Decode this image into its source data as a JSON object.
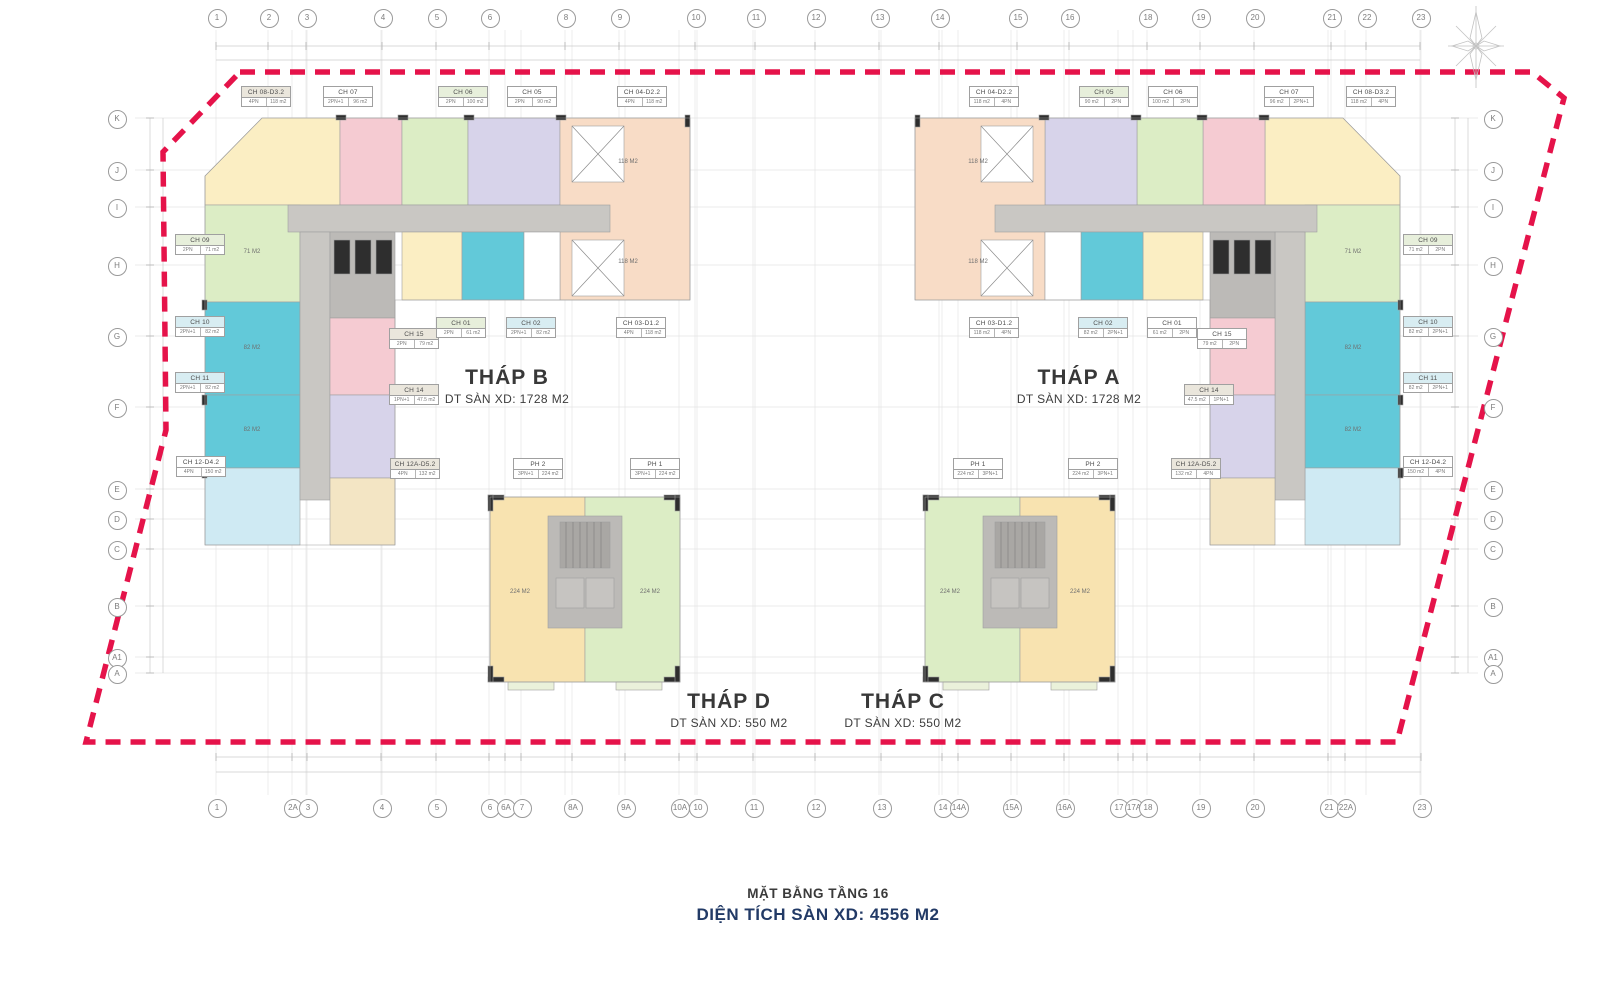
{
  "title": {
    "line1": "MẶT BẰNG TẦNG 16",
    "line2": "DIỆN TÍCH SÀN XD: 4556 M2"
  },
  "towers": [
    {
      "id": "B",
      "name": "THÁP B",
      "area": "DT SÀN XD: 1728 M2"
    },
    {
      "id": "A",
      "name": "THÁP A",
      "area": "DT SÀN XD: 1728 M2"
    },
    {
      "id": "D",
      "name": "THÁP D",
      "area": "DT SÀN XD: 550 M2"
    },
    {
      "id": "C",
      "name": "THÁP C",
      "area": "DT SÀN XD: 550 M2"
    }
  ],
  "grid": {
    "top_columns": [
      {
        "label": "1",
        "x": 216
      },
      {
        "label": "2",
        "x": 268
      },
      {
        "label": "3",
        "x": 306
      },
      {
        "label": "4",
        "x": 382
      },
      {
        "label": "5",
        "x": 436
      },
      {
        "label": "6",
        "x": 489
      },
      {
        "label": "8",
        "x": 565
      },
      {
        "label": "9",
        "x": 619
      },
      {
        "label": "10",
        "x": 695
      },
      {
        "label": "11",
        "x": 755
      },
      {
        "label": "12",
        "x": 815
      },
      {
        "label": "13",
        "x": 879
      },
      {
        "label": "14",
        "x": 939
      },
      {
        "label": "15",
        "x": 1017
      },
      {
        "label": "16",
        "x": 1069
      },
      {
        "label": "18",
        "x": 1147
      },
      {
        "label": "19",
        "x": 1200
      },
      {
        "label": "20",
        "x": 1254
      },
      {
        "label": "21",
        "x": 1331
      },
      {
        "label": "22",
        "x": 1366
      },
      {
        "label": "23",
        "x": 1420
      }
    ],
    "bottom_columns": [
      {
        "label": "1",
        "x": 216
      },
      {
        "label": "2A",
        "x": 292
      },
      {
        "label": "3",
        "x": 307
      },
      {
        "label": "4",
        "x": 381
      },
      {
        "label": "5",
        "x": 436
      },
      {
        "label": "6",
        "x": 489
      },
      {
        "label": "6A",
        "x": 505
      },
      {
        "label": "7",
        "x": 521
      },
      {
        "label": "8A",
        "x": 572
      },
      {
        "label": "9A",
        "x": 625
      },
      {
        "label": "10A",
        "x": 679
      },
      {
        "label": "10",
        "x": 697
      },
      {
        "label": "11",
        "x": 753
      },
      {
        "label": "12",
        "x": 815
      },
      {
        "label": "13",
        "x": 881
      },
      {
        "label": "14",
        "x": 942
      },
      {
        "label": "14A",
        "x": 958
      },
      {
        "label": "15A",
        "x": 1011
      },
      {
        "label": "16A",
        "x": 1064
      },
      {
        "label": "17",
        "x": 1118
      },
      {
        "label": "17A",
        "x": 1133
      },
      {
        "label": "18",
        "x": 1147
      },
      {
        "label": "19",
        "x": 1200
      },
      {
        "label": "20",
        "x": 1254
      },
      {
        "label": "21",
        "x": 1328
      },
      {
        "label": "22A",
        "x": 1345
      },
      {
        "label": "23",
        "x": 1421
      }
    ],
    "left_rows": [
      {
        "label": "K",
        "y": 118
      },
      {
        "label": "J",
        "y": 170
      },
      {
        "label": "I",
        "y": 207
      },
      {
        "label": "H",
        "y": 265
      },
      {
        "label": "G",
        "y": 336
      },
      {
        "label": "F",
        "y": 407
      },
      {
        "label": "E",
        "y": 489
      },
      {
        "label": "D",
        "y": 519
      },
      {
        "label": "C",
        "y": 549
      },
      {
        "label": "B",
        "y": 606
      },
      {
        "label": "A1",
        "y": 657
      },
      {
        "label": "A",
        "y": 673
      }
    ],
    "right_rows": [
      {
        "label": "K",
        "y": 118
      },
      {
        "label": "J",
        "y": 170
      },
      {
        "label": "I",
        "y": 207
      },
      {
        "label": "H",
        "y": 265
      },
      {
        "label": "G",
        "y": 336
      },
      {
        "label": "F",
        "y": 407
      },
      {
        "label": "E",
        "y": 489
      },
      {
        "label": "D",
        "y": 519
      },
      {
        "label": "C",
        "y": 549
      },
      {
        "label": "B",
        "y": 606
      },
      {
        "label": "A1",
        "y": 657
      },
      {
        "label": "A",
        "y": 673
      }
    ]
  },
  "unit_labels": [
    {
      "id": "CH 08-D3.2",
      "bed": "4PN",
      "area": "118 m2",
      "tint": "gray",
      "x": 266,
      "y": 95,
      "flip": false
    },
    {
      "id": "CH 07",
      "bed": "2PN+1",
      "area": "96 m2",
      "tint": "white",
      "x": 348,
      "y": 95,
      "flip": false
    },
    {
      "id": "CH 06",
      "bed": "2PN",
      "area": "100 m2",
      "tint": "green",
      "x": 463,
      "y": 95,
      "flip": false
    },
    {
      "id": "CH 05",
      "bed": "2PN",
      "area": "90 m2",
      "tint": "white",
      "x": 532,
      "y": 95,
      "flip": false
    },
    {
      "id": "CH 04-D2.2",
      "bed": "4PN",
      "area": "118 m2",
      "tint": "white",
      "x": 642,
      "y": 95,
      "flip": false
    },
    {
      "id": "CH 09",
      "bed": "2PN",
      "area": "71 m2",
      "tint": "green",
      "x": 200,
      "y": 243,
      "flip": false
    },
    {
      "id": "CH 10",
      "bed": "2PN+1",
      "area": "82 m2",
      "tint": "cyan",
      "x": 200,
      "y": 325,
      "flip": false
    },
    {
      "id": "CH 11",
      "bed": "2PN+1",
      "area": "82 m2",
      "tint": "cyan",
      "x": 200,
      "y": 381,
      "flip": false
    },
    {
      "id": "CH 12-D4.2",
      "bed": "4PN",
      "area": "150 m2",
      "tint": "white",
      "x": 201,
      "y": 465,
      "flip": false
    },
    {
      "id": "CH 15",
      "bed": "2PN",
      "area": "79 m2",
      "tint": "gray",
      "x": 414,
      "y": 337,
      "flip": false
    },
    {
      "id": "CH 01",
      "bed": "2PN",
      "area": "61 m2",
      "tint": "green",
      "x": 461,
      "y": 326,
      "flip": false
    },
    {
      "id": "CH 02",
      "bed": "2PN+1",
      "area": "82 m2",
      "tint": "cyan",
      "x": 531,
      "y": 326,
      "flip": false
    },
    {
      "id": "CH 03-D1.2",
      "bed": "4PN",
      "area": "118 m2",
      "tint": "white",
      "x": 641,
      "y": 326,
      "flip": false
    },
    {
      "id": "CH 14",
      "bed": "1PN+1",
      "area": "47.5 m2",
      "tint": "gray",
      "x": 414,
      "y": 393,
      "flip": false
    },
    {
      "id": "CH 12A-D5.2",
      "bed": "4PN",
      "area": "132 m2",
      "tint": "gray",
      "x": 415,
      "y": 467,
      "flip": false
    },
    {
      "id": "PH 2",
      "bed": "3PN+1",
      "area": "224 m2",
      "tint": "white",
      "x": 538,
      "y": 467,
      "flip": false
    },
    {
      "id": "PH 1",
      "bed": "3PN+1",
      "area": "224 m2",
      "tint": "white",
      "x": 655,
      "y": 467,
      "flip": false
    },
    {
      "id": "PH 1",
      "bed": "3PN+1",
      "area": "224 m2",
      "tint": "white",
      "x": 978,
      "y": 467,
      "flip": true
    },
    {
      "id": "PH 2",
      "bed": "3PN+1",
      "area": "224 m2",
      "tint": "white",
      "x": 1093,
      "y": 467,
      "flip": true
    },
    {
      "id": "CH 04-D2.2",
      "bed": "4PN",
      "area": "118 m2",
      "tint": "white",
      "x": 994,
      "y": 95,
      "flip": true
    },
    {
      "id": "CH 05",
      "bed": "2PN",
      "area": "90 m2",
      "tint": "green",
      "x": 1104,
      "y": 95,
      "flip": true
    },
    {
      "id": "CH 06",
      "bed": "2PN",
      "area": "100 m2",
      "tint": "white",
      "x": 1173,
      "y": 95,
      "flip": true
    },
    {
      "id": "CH 07",
      "bed": "2PN+1",
      "area": "96 m2",
      "tint": "white",
      "x": 1289,
      "y": 95,
      "flip": true
    },
    {
      "id": "CH 08-D3.2",
      "bed": "4PN",
      "area": "118 m2",
      "tint": "white",
      "x": 1371,
      "y": 95,
      "flip": true
    },
    {
      "id": "CH 03-D1.2",
      "bed": "4PN",
      "area": "118 m2",
      "tint": "white",
      "x": 994,
      "y": 326,
      "flip": true
    },
    {
      "id": "CH 02",
      "bed": "2PN+1",
      "area": "82 m2",
      "tint": "cyan",
      "x": 1103,
      "y": 326,
      "flip": true
    },
    {
      "id": "CH 01",
      "bed": "2PN",
      "area": "61 m2",
      "tint": "white",
      "x": 1172,
      "y": 326,
      "flip": true
    },
    {
      "id": "CH 15",
      "bed": "2PN",
      "area": "79 m2",
      "tint": "white",
      "x": 1222,
      "y": 337,
      "flip": true
    },
    {
      "id": "CH 14",
      "bed": "1PN+1",
      "area": "47.5 m2",
      "tint": "gray",
      "x": 1209,
      "y": 393,
      "flip": true
    },
    {
      "id": "CH 12A-D5.2",
      "bed": "4PN",
      "area": "132 m2",
      "tint": "gray",
      "x": 1196,
      "y": 467,
      "flip": true
    },
    {
      "id": "CH 09",
      "bed": "2PN",
      "area": "71 m2",
      "tint": "green",
      "x": 1428,
      "y": 243,
      "flip": true
    },
    {
      "id": "CH 10",
      "bed": "2PN+1",
      "area": "82 m2",
      "tint": "cyan",
      "x": 1428,
      "y": 325,
      "flip": true
    },
    {
      "id": "CH 11",
      "bed": "2PN+1",
      "area": "82 m2",
      "tint": "cyan",
      "x": 1428,
      "y": 381,
      "flip": true
    },
    {
      "id": "CH 12-D4.2",
      "bed": "4PN",
      "area": "150 m2",
      "tint": "white",
      "x": 1428,
      "y": 465,
      "flip": true
    }
  ],
  "in_plan_texts": [
    {
      "t": "71 M2",
      "x": 252,
      "y": 252
    },
    {
      "t": "82 M2",
      "x": 252,
      "y": 348
    },
    {
      "t": "82 M2",
      "x": 252,
      "y": 430
    },
    {
      "t": "118 M2",
      "x": 628,
      "y": 162
    },
    {
      "t": "118 M2",
      "x": 628,
      "y": 262
    },
    {
      "t": "71 M2",
      "x": 1353,
      "y": 252
    },
    {
      "t": "82 M2",
      "x": 1353,
      "y": 348
    },
    {
      "t": "82 M2",
      "x": 1353,
      "y": 430
    },
    {
      "t": "118 M2",
      "x": 978,
      "y": 162
    },
    {
      "t": "118 M2",
      "x": 978,
      "y": 262
    },
    {
      "t": "224 M2",
      "x": 520,
      "y": 592
    },
    {
      "t": "224 M2",
      "x": 650,
      "y": 592
    },
    {
      "t": "224 M2",
      "x": 950,
      "y": 592
    },
    {
      "t": "224 M2",
      "x": 1080,
      "y": 592
    }
  ],
  "colors": {
    "boundary": "#e5134a",
    "peach": "#f8dcc6",
    "yellow": "#fbeec3",
    "pink": "#f5cbd2",
    "green": "#dcedc5",
    "lavender": "#d7d3ea",
    "teal": "#62c9d9",
    "lightcyan": "#cfeaf3",
    "cream": "#f3e5c4",
    "orange": "#f8e3b0",
    "corridor": "#c9c7c3",
    "core": "#bcbab7",
    "gridline": "#e4e4e4",
    "circle": "#9a9a9a",
    "subtitle": "#223a66"
  }
}
